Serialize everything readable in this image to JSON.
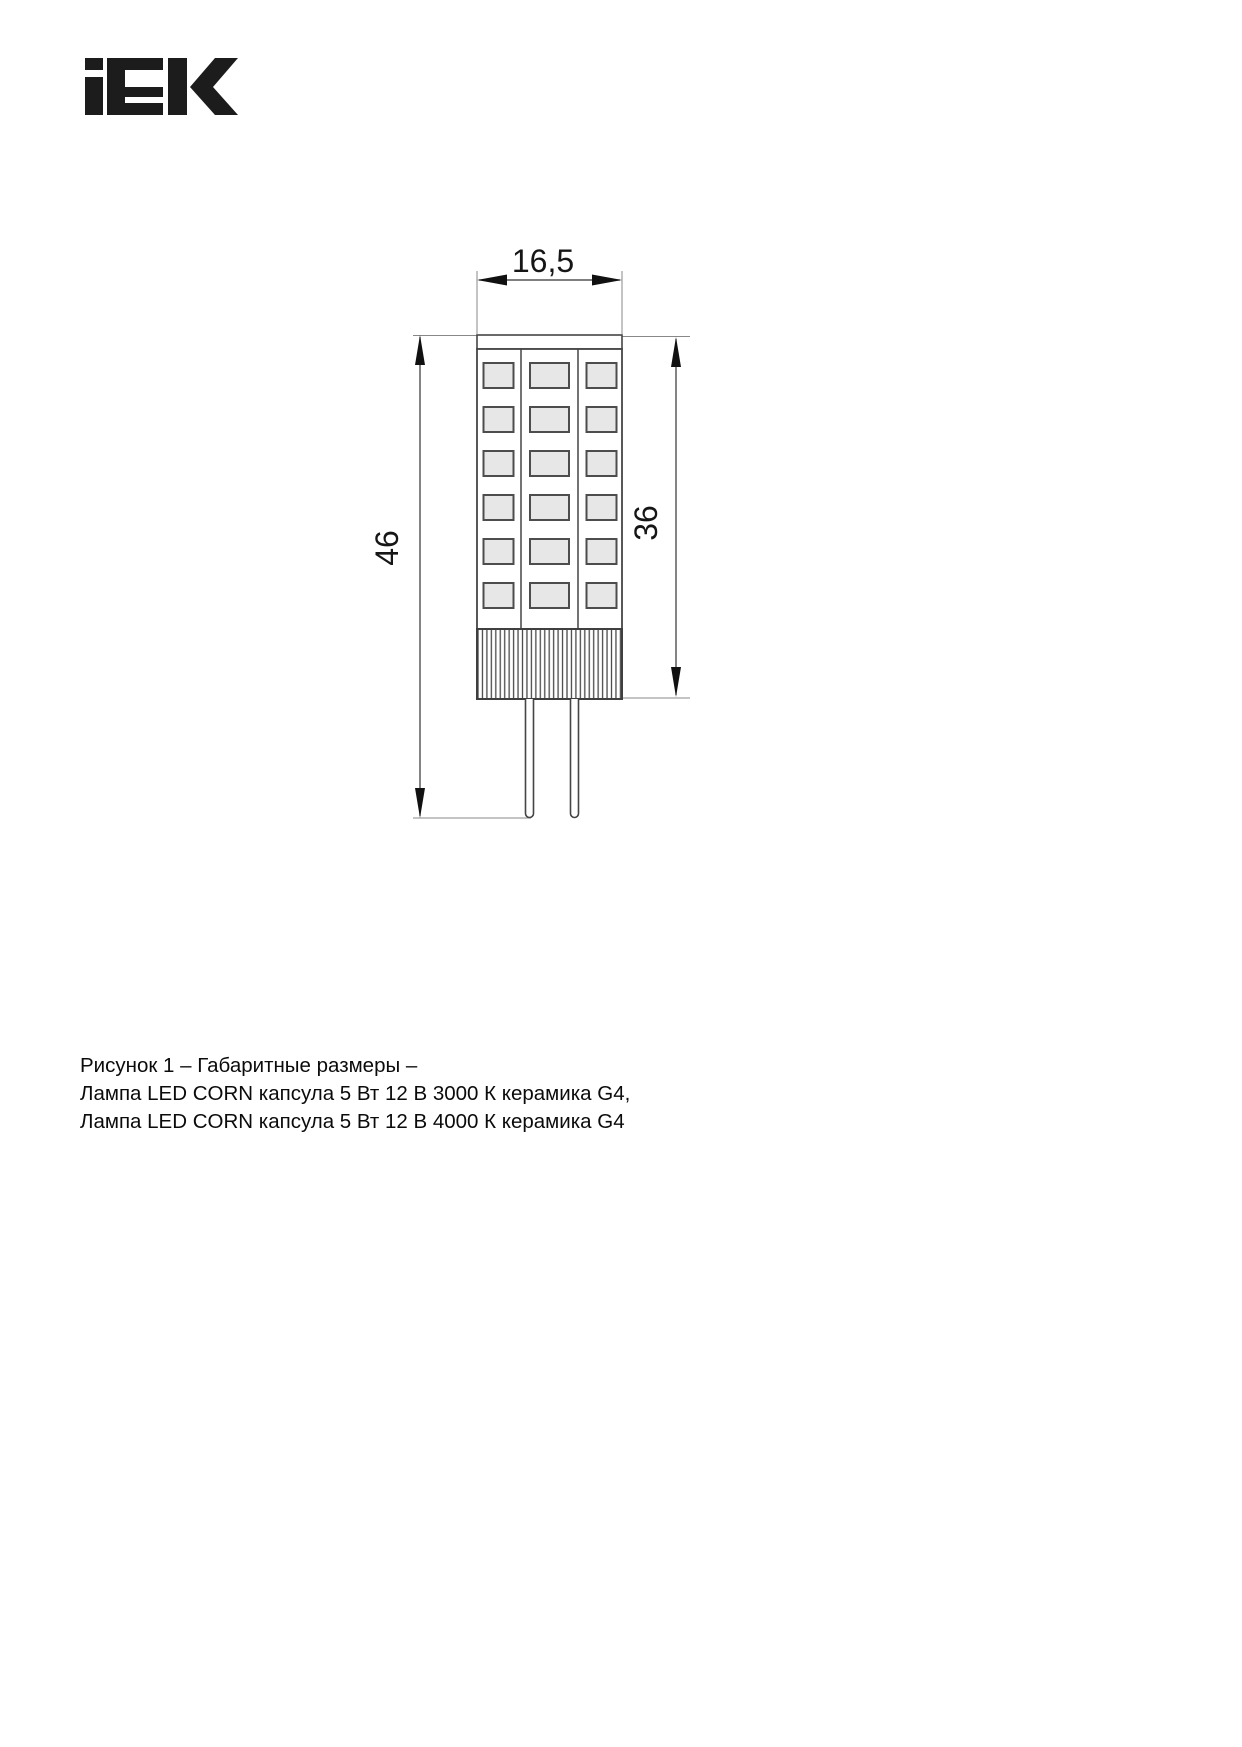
{
  "logo": {
    "brand": "IEK"
  },
  "drawing": {
    "type": "technical-dimension-drawing",
    "subject": "LED CORN capsule lamp with G4 base, front view",
    "dimensions": {
      "width_top": "16,5",
      "height_total": "46",
      "height_body": "36"
    },
    "led_grid": {
      "rows": 6,
      "columns": 3
    },
    "pins": 2
  },
  "caption": {
    "line1": "Рисунок 1 – Габаритные размеры –",
    "line2": "Лампа LED CORN капсула 5 Вт 12 В 3000 К керамика G4,",
    "line3": "Лампа LED CORN капсула 5 Вт 12 В 4000 К керамика G4"
  }
}
